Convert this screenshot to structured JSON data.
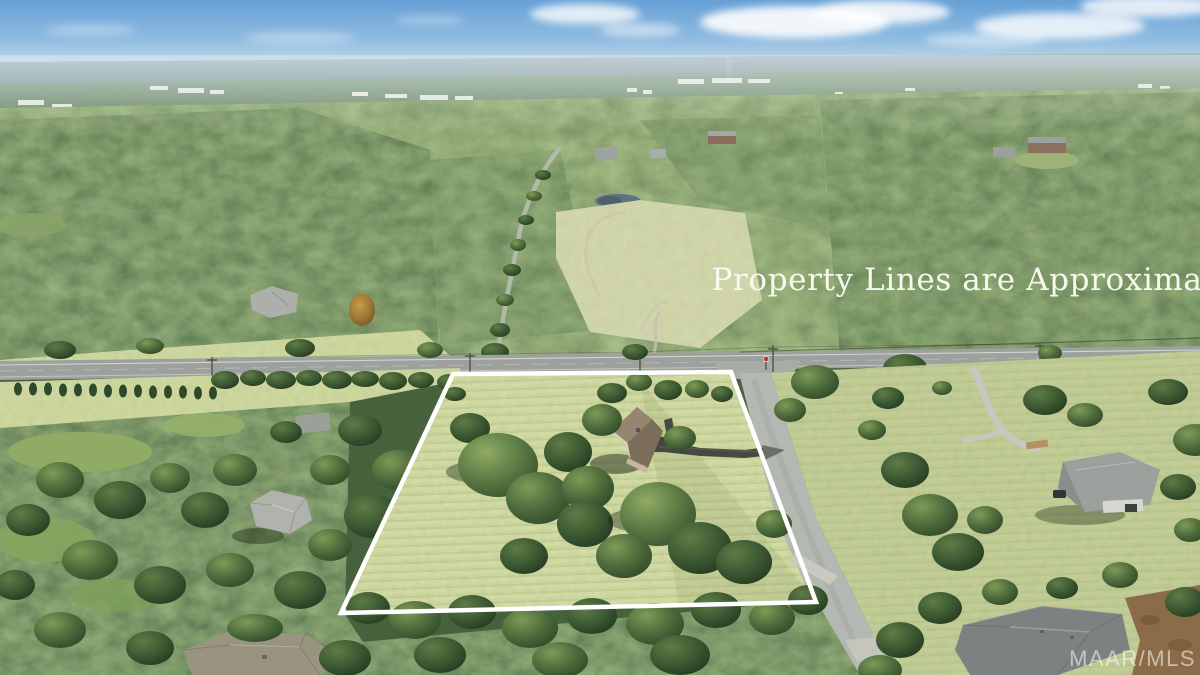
{
  "photo": {
    "type": "aerial-drone-photograph",
    "subject": "rural residential property with outlined parcel, roads and surrounding woodland",
    "disclaimer_text": "Property Lines are Approximate",
    "watermark_text": "MAAR/MLS"
  },
  "boundary": {
    "points": "453,374 731,372 816,602 341,613",
    "color": "#ffffff",
    "stroke_width": "4.5"
  },
  "palette": {
    "sky_top": "#649fd6",
    "sky_horizon": "#c8dcea",
    "haze_ridge": "#9fb4bc",
    "forest_dark": "#33502a",
    "forest_mid": "#47662d",
    "lawn": "#99ab54",
    "pasture": "#a8ba7c",
    "pond": "#5d7181",
    "main_road": "#9ca19d",
    "side_road": "#b4b8b2",
    "asphalt_driveway": "#42463d",
    "house_roof_brown": "#8a7a66",
    "house_roof_gray": "#9aa09c",
    "pine_straw": "#8a6a45",
    "overlay_white": "#ffffff"
  }
}
